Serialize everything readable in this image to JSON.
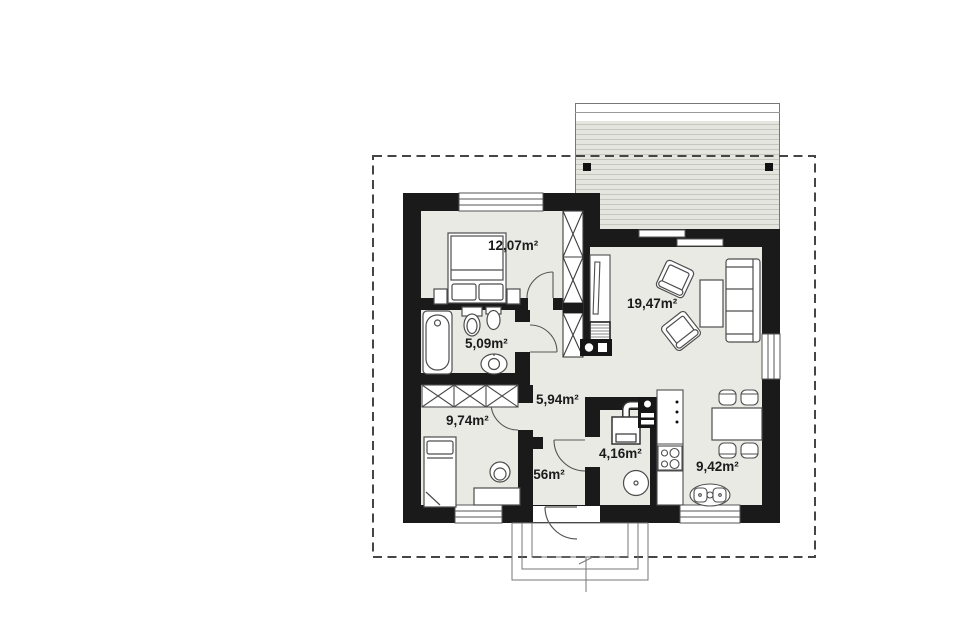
{
  "page": {
    "type": "architectural-floor-plan",
    "background": "#ffffff"
  },
  "colors": {
    "wall": "#1a1a1a",
    "floor": "#eaeae5",
    "terrace": "#e3e5de",
    "terrace_stripe": "#c3c7bd",
    "line": "#4d4d4d",
    "boundary": "#454545",
    "label": "#1b1b1b"
  },
  "rooms": [
    {
      "id": "bedroom-1",
      "area": "12,07m²"
    },
    {
      "id": "living-room",
      "area": "19,47m²"
    },
    {
      "id": "bathroom",
      "area": "5,09m²"
    },
    {
      "id": "bedroom-2",
      "area": "9,74m²"
    },
    {
      "id": "hallway",
      "area": "5,94m²"
    },
    {
      "id": "entry-hall",
      "area": "2,56m²"
    },
    {
      "id": "boiler-room",
      "area": "4,16m²"
    },
    {
      "id": "kitchen-dining",
      "area": "9,42m²"
    }
  ]
}
